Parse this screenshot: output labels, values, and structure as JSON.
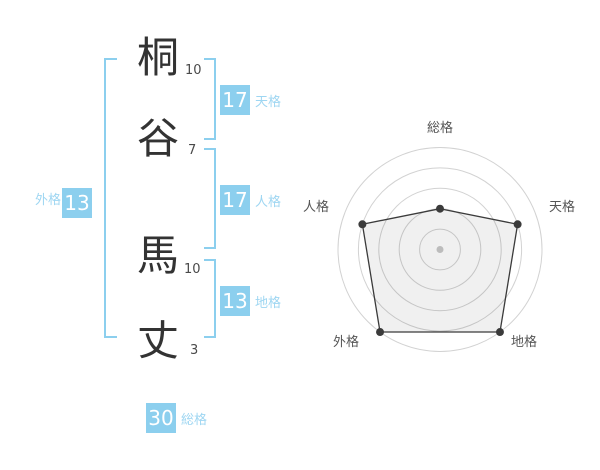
{
  "name_diagram": {
    "characters": [
      {
        "char": "桐",
        "strokes": "10"
      },
      {
        "char": "谷",
        "strokes": "7"
      },
      {
        "char": "馬",
        "strokes": "10"
      },
      {
        "char": "丈",
        "strokes": "3"
      }
    ],
    "kaku": {
      "tenkaku": {
        "label": "天格",
        "value": "17"
      },
      "jinkaku": {
        "label": "人格",
        "value": "17"
      },
      "chikaku": {
        "label": "地格",
        "value": "13"
      },
      "gaikaku": {
        "label": "外格",
        "value": "13"
      },
      "soukaku": {
        "label": "総格",
        "value": "30"
      }
    },
    "accent_color": "#8ccfee",
    "label_color": "#9ed6f2",
    "text_color": "#333333"
  },
  "chart_data": {
    "type": "radar",
    "axes": [
      "総格",
      "天格",
      "地格",
      "外格",
      "人格"
    ],
    "levels": [
      2,
      4,
      5,
      5,
      4
    ],
    "max_level": 5,
    "rings": 5,
    "grid": "circular",
    "legend": "none",
    "grid_color": "#d2d2d2",
    "line_color": "#3b3b3b",
    "fill_color": "rgba(0,0,0,0.06)",
    "center_dot_color": "#bcbcbc",
    "label_color": "#555555"
  }
}
